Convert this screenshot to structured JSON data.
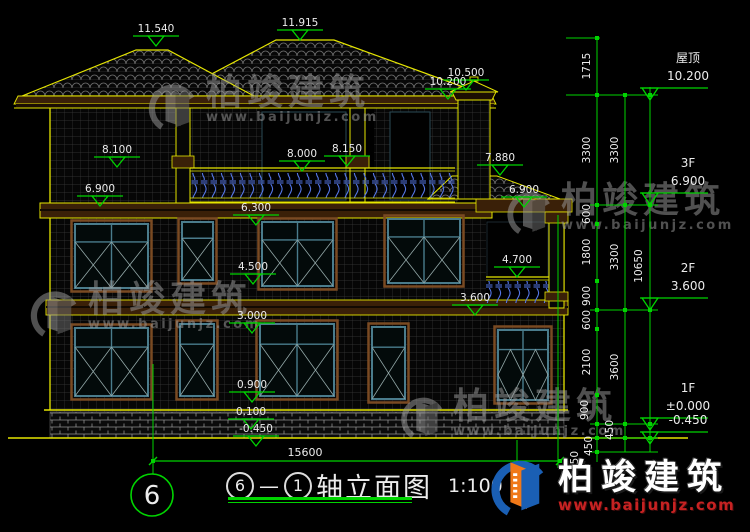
{
  "colors": {
    "cad_yellow": "#e6e600",
    "cad_green": "#00d400",
    "text_white": "#ececec",
    "watermark_gray": "#9a9a9a",
    "brand_blue": "#1a5fb4",
    "brand_orange": "#f07818",
    "brand_red": "#c62222"
  },
  "title_block": {
    "axis_a": "6",
    "dash": "—",
    "axis_b": "1",
    "name": "轴立面图",
    "scale": "1:100"
  },
  "axis_bubble": {
    "label": "6"
  },
  "watermark": {
    "text": "柏竣建筑",
    "url": "www.baijunjz.com"
  },
  "brand": {
    "name": "柏竣建筑",
    "url": "www.baijunjz.com"
  },
  "right_levels": [
    {
      "name": "屋顶",
      "value": "10.200",
      "y": 88
    },
    {
      "name": "3F",
      "value": "6.900",
      "y": 193
    },
    {
      "name": "2F",
      "value": "3.600",
      "y": 298
    },
    {
      "name": "1F",
      "value": "±0.000",
      "y": 418
    },
    {
      "name": "",
      "value": "-0.450",
      "y": 432
    }
  ],
  "spot_markers": [
    {
      "label": "11.540",
      "cx": 156,
      "y": 36
    },
    {
      "label": "11.915",
      "cx": 300,
      "y": 30
    },
    {
      "label": "10.500",
      "cx": 466,
      "y": 80
    },
    {
      "label": "10.200",
      "cx": 448,
      "y": 89
    },
    {
      "label": "8.100",
      "cx": 117,
      "y": 157
    },
    {
      "label": "8.000",
      "cx": 302,
      "y": 161
    },
    {
      "label": "8.150",
      "cx": 347,
      "y": 156
    },
    {
      "label": "7.880",
      "cx": 500,
      "y": 165
    },
    {
      "label": "6.900",
      "cx": 100,
      "y": 196
    },
    {
      "label": "6.900",
      "cx": 524,
      "y": 197
    },
    {
      "label": "6.300",
      "cx": 256,
      "y": 215
    },
    {
      "label": "4.500",
      "cx": 253,
      "y": 274
    },
    {
      "label": "4.700",
      "cx": 517,
      "y": 267
    },
    {
      "label": "3.600",
      "cx": 475,
      "y": 305
    },
    {
      "label": "3.000",
      "cx": 252,
      "y": 323
    },
    {
      "label": "0.900",
      "cx": 252,
      "y": 392
    },
    {
      "label": "0.100",
      "cx": 251,
      "y": 419
    },
    {
      "label": "-0.450",
      "cx": 256,
      "y": 436
    }
  ],
  "dim_chains": {
    "verticals": [
      {
        "x": 597,
        "y1": 38,
        "y2": 462,
        "ticks": [
          38,
          95,
          205,
          224,
          281,
          310,
          329,
          395,
          424,
          438,
          452
        ]
      },
      {
        "x": 625,
        "y1": 95,
        "y2": 452,
        "ticks": [
          95,
          205,
          310,
          424,
          438
        ]
      },
      {
        "x": 650,
        "y1": 87,
        "y2": 452,
        "ticks": [
          95,
          205,
          310,
          424,
          438
        ]
      }
    ],
    "labels": [
      {
        "v": "1715",
        "x": 590,
        "y": 66
      },
      {
        "v": "3300",
        "x": 590,
        "y": 150
      },
      {
        "v": "600",
        "x": 590,
        "y": 214
      },
      {
        "v": "1800",
        "x": 590,
        "y": 252
      },
      {
        "v": "900",
        "x": 590,
        "y": 296
      },
      {
        "v": "600",
        "x": 590,
        "y": 320
      },
      {
        "v": "2100",
        "x": 590,
        "y": 362
      },
      {
        "v": "900",
        "x": 588,
        "y": 410
      },
      {
        "v": "450",
        "x": 592,
        "y": 446
      },
      {
        "v": "450",
        "x": 578,
        "y": 461
      },
      {
        "v": "3300",
        "x": 618,
        "y": 150
      },
      {
        "v": "3300",
        "x": 618,
        "y": 257
      },
      {
        "v": "3600",
        "x": 618,
        "y": 367
      },
      {
        "v": "450",
        "x": 613,
        "y": 430
      },
      {
        "v": "10650",
        "x": 642,
        "y": 266
      }
    ],
    "h_ticks": [
      {
        "x1": 566,
        "x2": 600,
        "y": 38
      },
      {
        "x1": 566,
        "x2": 658,
        "y": 95
      },
      {
        "x1": 590,
        "x2": 658,
        "y": 205
      },
      {
        "x1": 590,
        "x2": 658,
        "y": 310
      },
      {
        "x1": 590,
        "x2": 658,
        "y": 424
      },
      {
        "x1": 590,
        "x2": 658,
        "y": 438
      },
      {
        "x1": 590,
        "x2": 658,
        "y": 452
      }
    ],
    "extensions": [
      {
        "x": 153,
        "y1": 364,
        "y2": 474
      },
      {
        "x": 558,
        "y1": 215,
        "y2": 468
      },
      {
        "x": 517,
        "y1": 440,
        "y2": 467
      }
    ]
  },
  "bottom_dim": {
    "label": "15600",
    "x1": 153,
    "x2": 560,
    "y": 461,
    "tx": 305
  }
}
